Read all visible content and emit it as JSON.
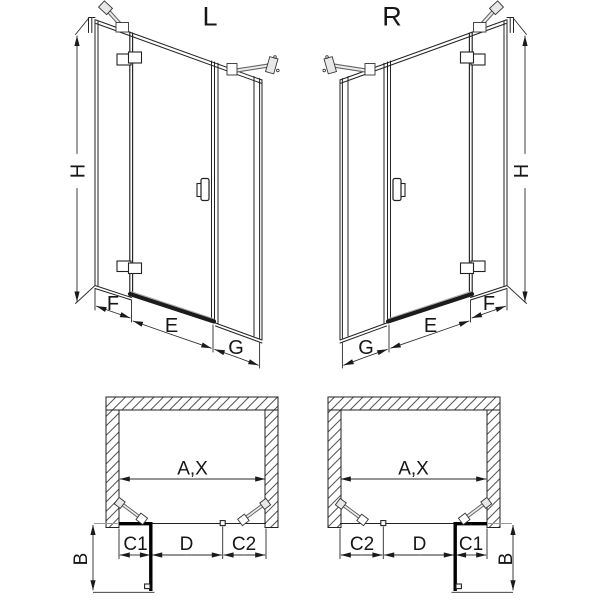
{
  "variants": {
    "left": {
      "title": "L"
    },
    "right": {
      "title": "R"
    }
  },
  "elevation_dims": {
    "height": "H",
    "side_panel": "F",
    "door_width": "E",
    "inline_panel": "G"
  },
  "plan_dims": {
    "opening_width": "A,X",
    "c1": "C1",
    "door": "D",
    "c2": "C2",
    "projection": "B"
  },
  "colors": {
    "line": "#222222",
    "dim_line": "#2a2a2a",
    "thick_element": "#000000",
    "hatch": "#555555",
    "light_extension": "#999999",
    "hardware_fill": "#e8e8e8"
  }
}
